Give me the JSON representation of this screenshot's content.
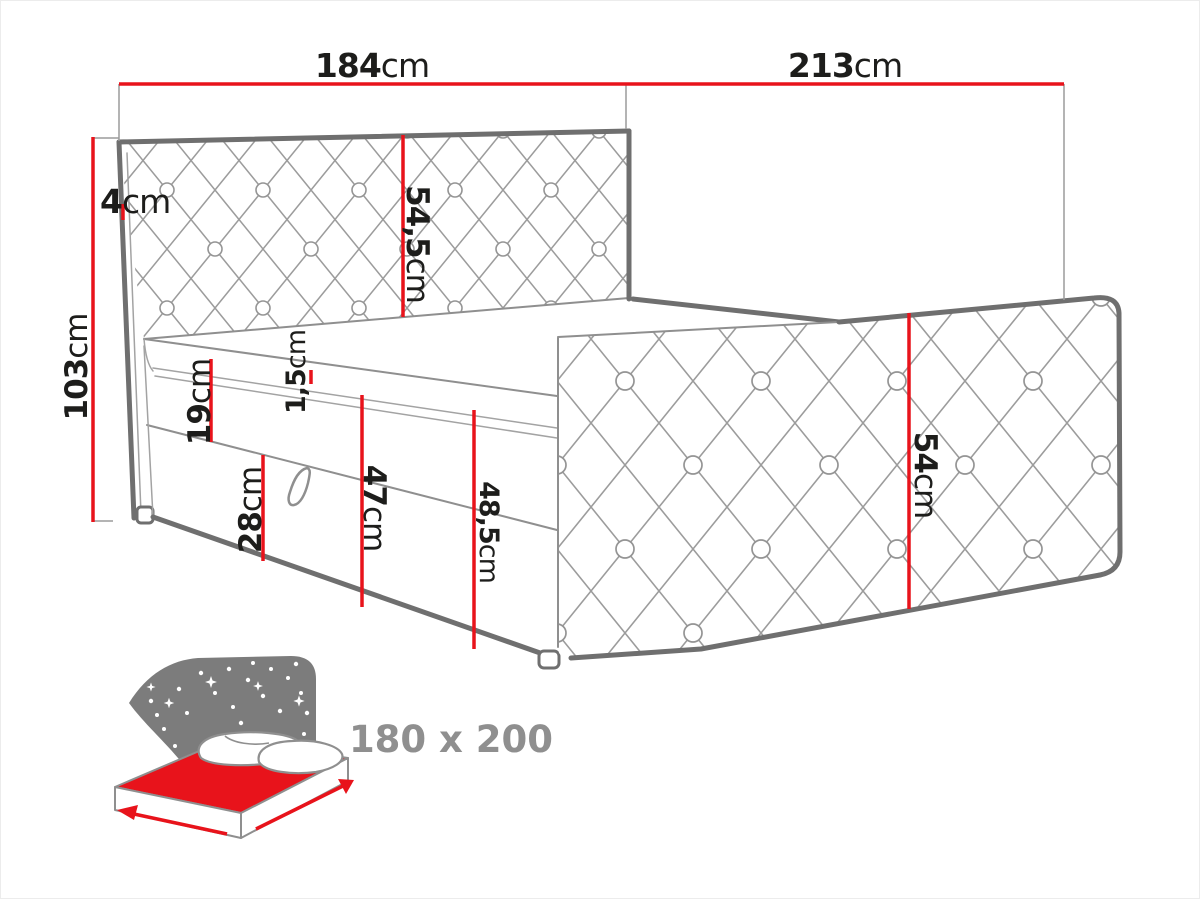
{
  "diagram": {
    "type": "bed-dimension-drawing",
    "dims": {
      "headboard_width": {
        "num": "184",
        "unit": "cm"
      },
      "bed_length": {
        "num": "213",
        "unit": "cm"
      },
      "headboard_thickness": {
        "num": "4",
        "unit": "cm"
      },
      "total_height": {
        "num": "103",
        "unit": "cm"
      },
      "headboard_panel": {
        "num": "54,5",
        "unit": "cm"
      },
      "upper_box": {
        "num": "19",
        "unit": "cm"
      },
      "welt": {
        "num": "1,5",
        "unit": "cm"
      },
      "drawer": {
        "num": "28",
        "unit": "cm"
      },
      "base_height": {
        "num": "47",
        "unit": "cm"
      },
      "side_height": {
        "num": "48,5",
        "unit": "cm"
      },
      "footboard_panel": {
        "num": "54",
        "unit": "cm"
      }
    },
    "icon": {
      "mattress_size_label": "180 x 200"
    },
    "colors": {
      "dimension_red": "#e8131b",
      "outline_gray": "#6f6f6f",
      "lattice_gray": "#9c9c9c",
      "label_dark": "#1d1d1b",
      "icon_sky_gray": "#7c7c7c",
      "icon_mattress_red": "#e8131b",
      "size_label_gray": "#8f8f8f"
    }
  }
}
